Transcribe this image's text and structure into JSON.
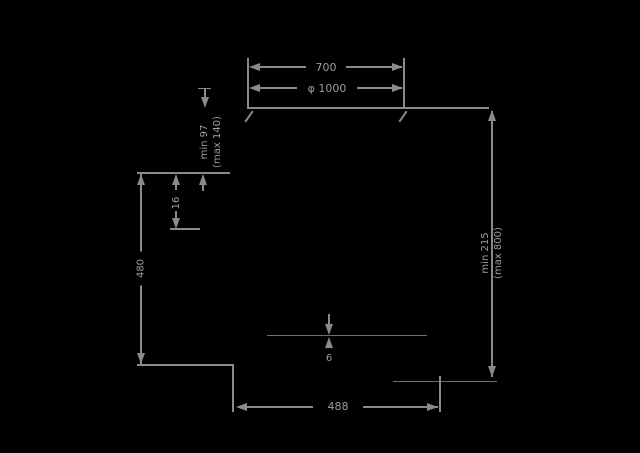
{
  "title": "installation-dimension-drawing",
  "colors": {
    "background": "#000000",
    "line": "#8a8a8a",
    "text": "#9c9c9c"
  },
  "labels": {
    "top_width": "700",
    "diameter": "φ 1000",
    "left_gap_min": "min 97",
    "left_gap_max": "(max 140)",
    "step_height": "16",
    "left_height": "480",
    "right_gap_min": "min 215",
    "right_gap_max": "(max 800)",
    "bottom_width": "488",
    "thickness": "6"
  }
}
